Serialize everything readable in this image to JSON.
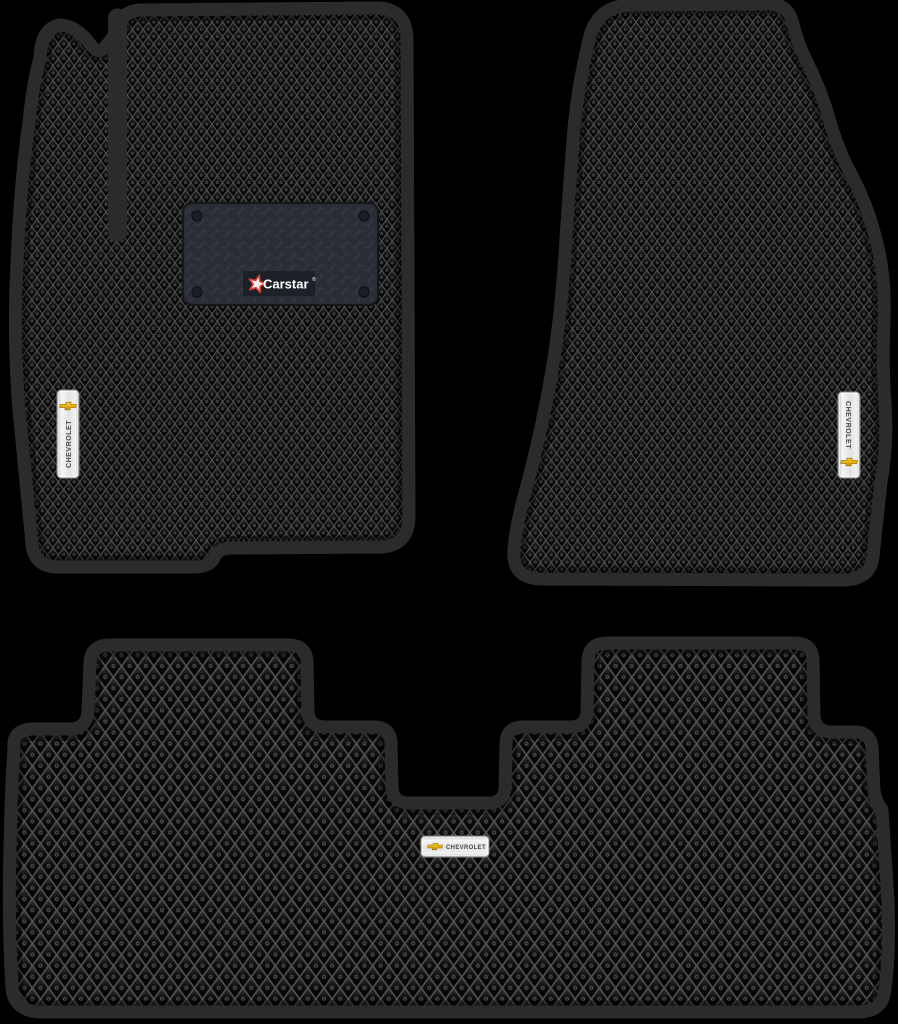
{
  "canvas": {
    "width": 898,
    "height": 1024,
    "background": "#000000"
  },
  "product": {
    "description": "Set of three black EVA diamond-pattern car floor mats",
    "mat_count": 3
  },
  "colors": {
    "background": "#000000",
    "mat_border": "#2b2b2b",
    "lattice": "#515151",
    "diamond_dark": "#0a0a0a",
    "heel_pad_bg": "#2a2d35",
    "heel_pad_plaque": "#1d2026",
    "badge_silver": "#ececec",
    "badge_text": "#4a4a4a",
    "bowtie_gold": "#e8b115",
    "logo_red": "#e03c31",
    "logo_text": "#ffffff"
  },
  "icons": {
    "chevrolet_bowtie": "gold cross / bowtie emblem",
    "carstar_star": "red outlined five-point star"
  },
  "mats": {
    "front_left": {
      "label": "front-left driver mat",
      "heel_pad": {
        "brand": "Carstar",
        "registered_mark": "®"
      },
      "badge": {
        "text": "CHEVROLET"
      }
    },
    "front_right": {
      "label": "front-right passenger mat",
      "badge": {
        "text": "CHEVROLET"
      }
    },
    "rear": {
      "label": "rear bench mat",
      "badge": {
        "text": "CHEVROLET"
      }
    }
  }
}
